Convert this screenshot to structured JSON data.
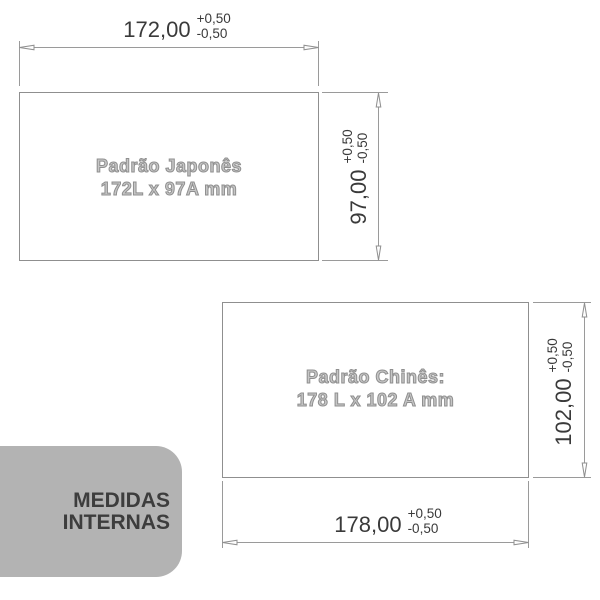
{
  "japanese": {
    "name_line1": "Padrão Japonês",
    "name_line2": "172L x 97A mm",
    "width_dim": {
      "value": "172,00",
      "tol_plus": "+0,50",
      "tol_minus": "-0,50"
    },
    "height_dim": {
      "value": "97,00",
      "tol_plus": "+0,50",
      "tol_minus": "-0,50"
    }
  },
  "chinese": {
    "name_line1": "Padrão Chinês:",
    "name_line2": "178 L x 102 A mm",
    "width_dim": {
      "value": "178,00",
      "tol_plus": "+0,50",
      "tol_minus": "-0,50"
    },
    "height_dim": {
      "value": "102,00",
      "tol_plus": "+0,50",
      "tol_minus": "-0,50"
    }
  },
  "badge": {
    "line1": "MEDIDAS",
    "line2": "INTERNAS"
  },
  "colors": {
    "line": "#9a9a9a",
    "dim_text": "#3a3a3a",
    "rect_label_outline": "#8f8f8f",
    "badge_bg": "#b3b3b3",
    "badge_text": "#3d3d3d",
    "background": "#ffffff"
  }
}
